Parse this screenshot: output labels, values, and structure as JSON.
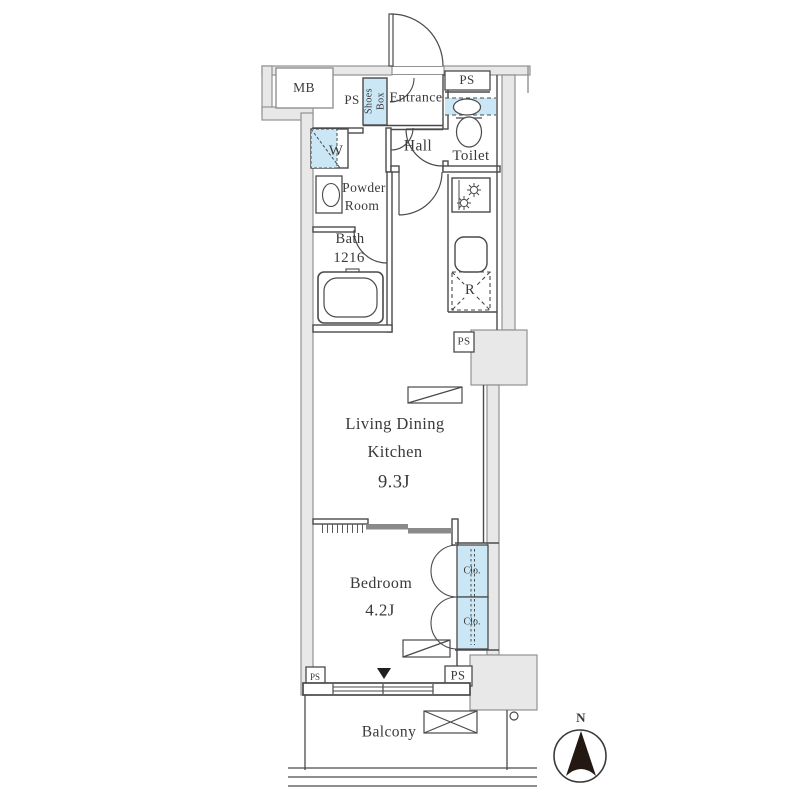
{
  "meta": {
    "type": "apartment-floor-plan",
    "colors": {
      "wall_fill": "#e8e8e8",
      "wall_stroke": "#919191",
      "line": "#4a4a4a",
      "fixture_blue": "#cbe7f5",
      "door_panel": "#8a8a8a",
      "text": "#3a3a3a"
    }
  },
  "labels": {
    "meter_box": "MB",
    "pipe_space": "PS",
    "shoes_box": "Shoes\nBox",
    "entrance": "Entrance",
    "hall": "Hall",
    "toilet": "Toilet",
    "washing_machine": "W",
    "powder_room_line1": "Powder",
    "powder_room_line2": "Room",
    "bath": "Bath",
    "bath_size": "1216",
    "refrigerator": "R",
    "ldk_line1": "Living Dining",
    "ldk_line2": "Kitchen",
    "ldk_size": "9.3J",
    "bedroom": "Bedroom",
    "bedroom_size": "4.2J",
    "closet": "Clo.",
    "balcony": "Balcony",
    "north": "N"
  }
}
